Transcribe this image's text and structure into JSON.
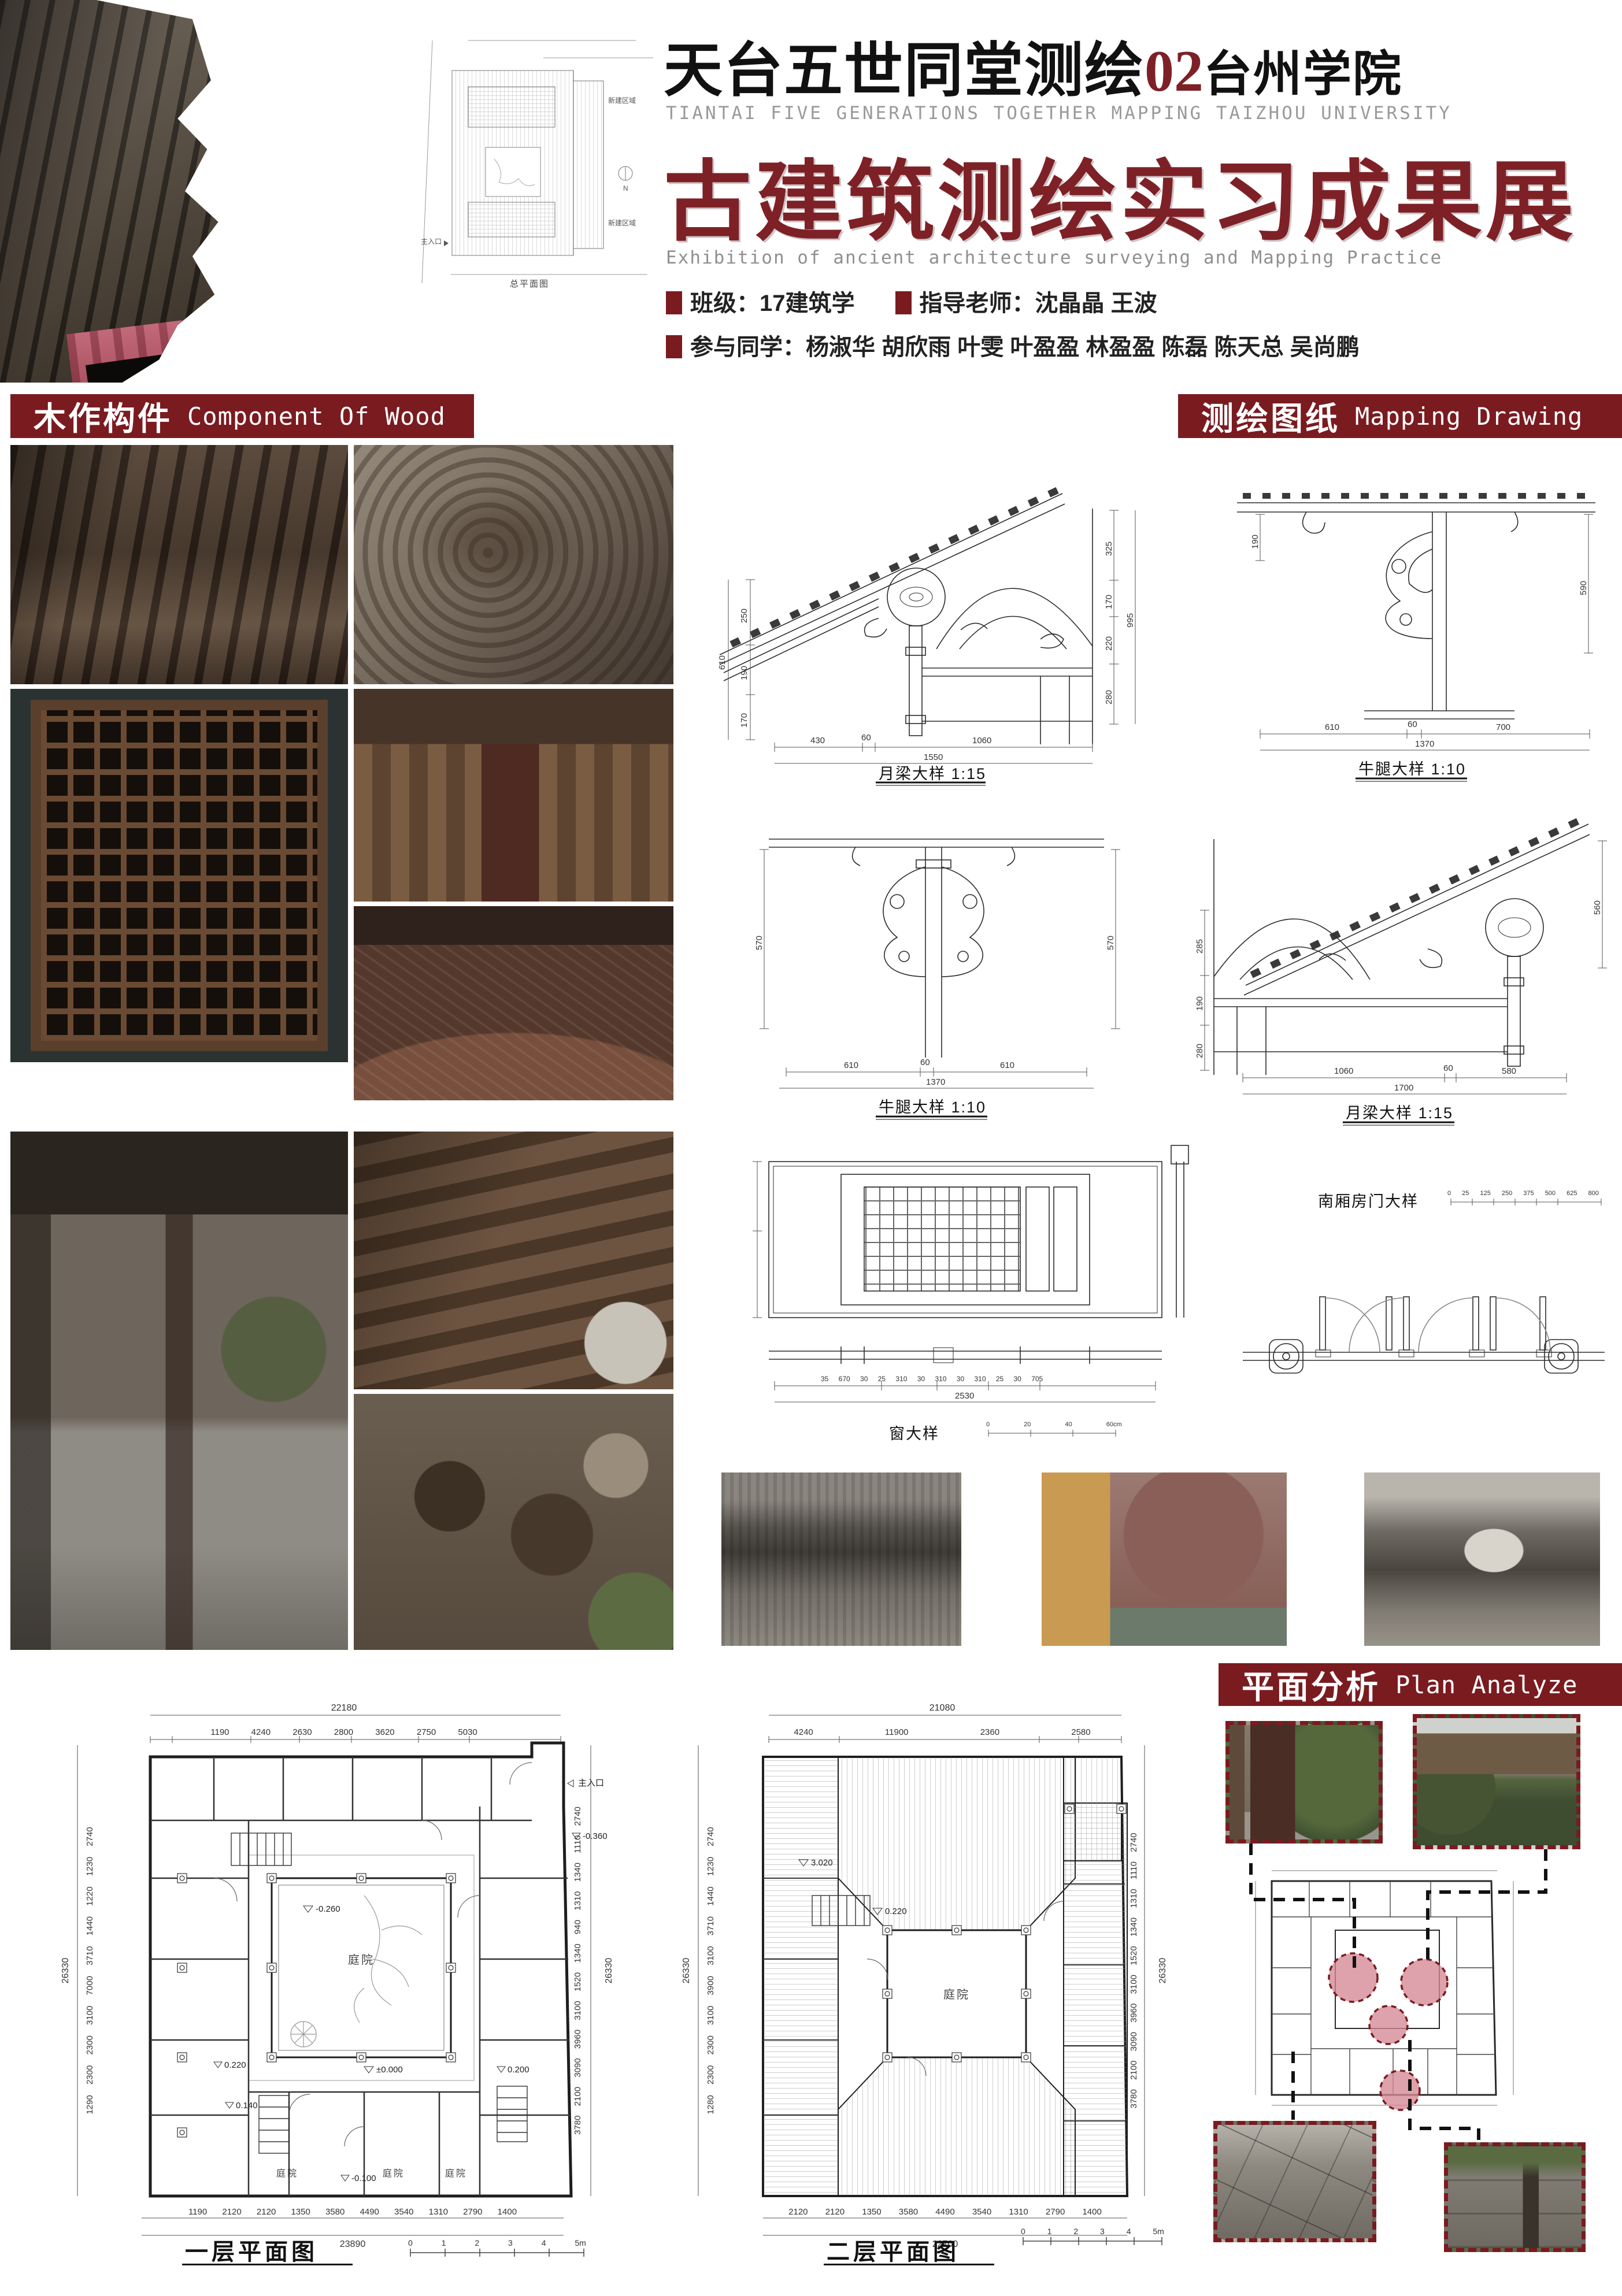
{
  "colors": {
    "accent": "#7a1b20",
    "title_red": "#7d2127",
    "circle_pink": "#d48893"
  },
  "header": {
    "title_zh": "天台五世同堂测绘",
    "title_num": "02",
    "title_org": "台州学院",
    "title_en": "TIANTAI FIVE GENERATIONS TOGETHER MAPPING TAIZHOU UNIVERSITY",
    "main_title": "古建筑测绘实习成果展",
    "main_title_en": "Exhibition of ancient architecture surveying and Mapping Practice",
    "class_info": "班级：17建筑学",
    "teacher_info": "指导老师：沈晶晶 王波",
    "students_info": "参与同学：杨淑华 胡欣雨 叶雯 叶盈盈 林盈盈 陈磊 陈天总 吴尚鹏"
  },
  "site_plan": {
    "caption": "总平面图",
    "entrance": "主入口",
    "area_top": "新建区域",
    "area_bottom": "新建区域",
    "north": "N"
  },
  "sections": {
    "wood_zh": "木作构件",
    "wood_en": "Component Of Wood",
    "mapping_zh": "测绘图纸",
    "mapping_en": "Mapping Drawing",
    "plan_zh": "平面分析",
    "plan_en": "Plan Analyze"
  },
  "drawings": {
    "d1": {
      "caption": "月梁大样 1:15",
      "left_total": "610",
      "left_dims": [
        "250",
        "190",
        "170"
      ],
      "right_total": "995",
      "right_dims": [
        "325",
        "170",
        "220",
        "280"
      ],
      "bottom_dims": [
        "430",
        "60",
        "1060"
      ],
      "bottom_total": "1550"
    },
    "d2": {
      "caption": "牛腿大样 1:10",
      "left_dim": "190",
      "right_dim": "590",
      "bottom_dims": [
        "610",
        "60",
        "700"
      ],
      "bottom_total": "1370"
    },
    "d3": {
      "caption": "牛腿大样 1:10",
      "left_dim": "570",
      "right_dim": "570",
      "bottom_dims": [
        "610",
        "60",
        "610"
      ],
      "bottom_total": "1370"
    },
    "d4": {
      "caption": "月梁大样 1:15",
      "left_dims": [
        "285",
        "190",
        "280"
      ],
      "right_dim": "560",
      "bottom_dims": [
        "1060",
        "60",
        "580"
      ],
      "bottom_total": "1700"
    },
    "d5": {
      "caption": "窗大样",
      "bottom_dims": "35 670 30 25 310 30 310 30 310 25 30 705",
      "bottom_total": "2530",
      "scale_labels": "0 20 40 60cm"
    },
    "d6": {
      "caption": "南厢房门大样",
      "scale_labels": "0 25 125 250 375 500 625 800"
    }
  },
  "plans": {
    "first": {
      "caption": "一层平面图",
      "top_total": "22180",
      "top_dims": "1190 4240 2630 2800 3620 2750 5030",
      "bottom_dims": "1190 2120 2120 1350 3580 4490 3540 1310 2790 1400",
      "bottom_total": "23890",
      "left_total": "26330",
      "left_dims": "1290 2300 2300 3100 7000 3710 1440 1220 1230 2740",
      "right_total": "26330",
      "right_dims": "3780 2100 3090 3960 3100 1520 1340 940 1310 1340 1110 2740",
      "courtyard": "庭院",
      "courtyard2": "庭院",
      "courtyard3": "庭院",
      "courtyard4": "庭院",
      "entrance": "主入口",
      "lv_a": "-0.260",
      "lv_b": "±0.000",
      "lv_c": "0.140",
      "lv_d": "0.220",
      "lv_e": "0.200",
      "lv_f": "-0.100",
      "lv_g": "-0.360",
      "scale": "0 1 2 3 4 5m"
    },
    "second": {
      "caption": "二层平面图",
      "top_total": "21080",
      "top_dims": "4240 11900 2360 2580",
      "bottom_dims": "2120 2120 1350 3580 4490 3540 1310 2790 1400",
      "bottom_total": "22700",
      "left_total": "26330",
      "left_dims": "1280 2300 2300 3100 3900 3100 3710 1440 1230 2740",
      "right_total": "26330",
      "right_dims": "3780 2100 3090 3960 3100 1520 1340 1310 1110 2740",
      "courtyard": "庭院",
      "lv_a": "3.020",
      "lv_b": "0.220",
      "scale": "0 1 2 3 4 5m"
    }
  }
}
